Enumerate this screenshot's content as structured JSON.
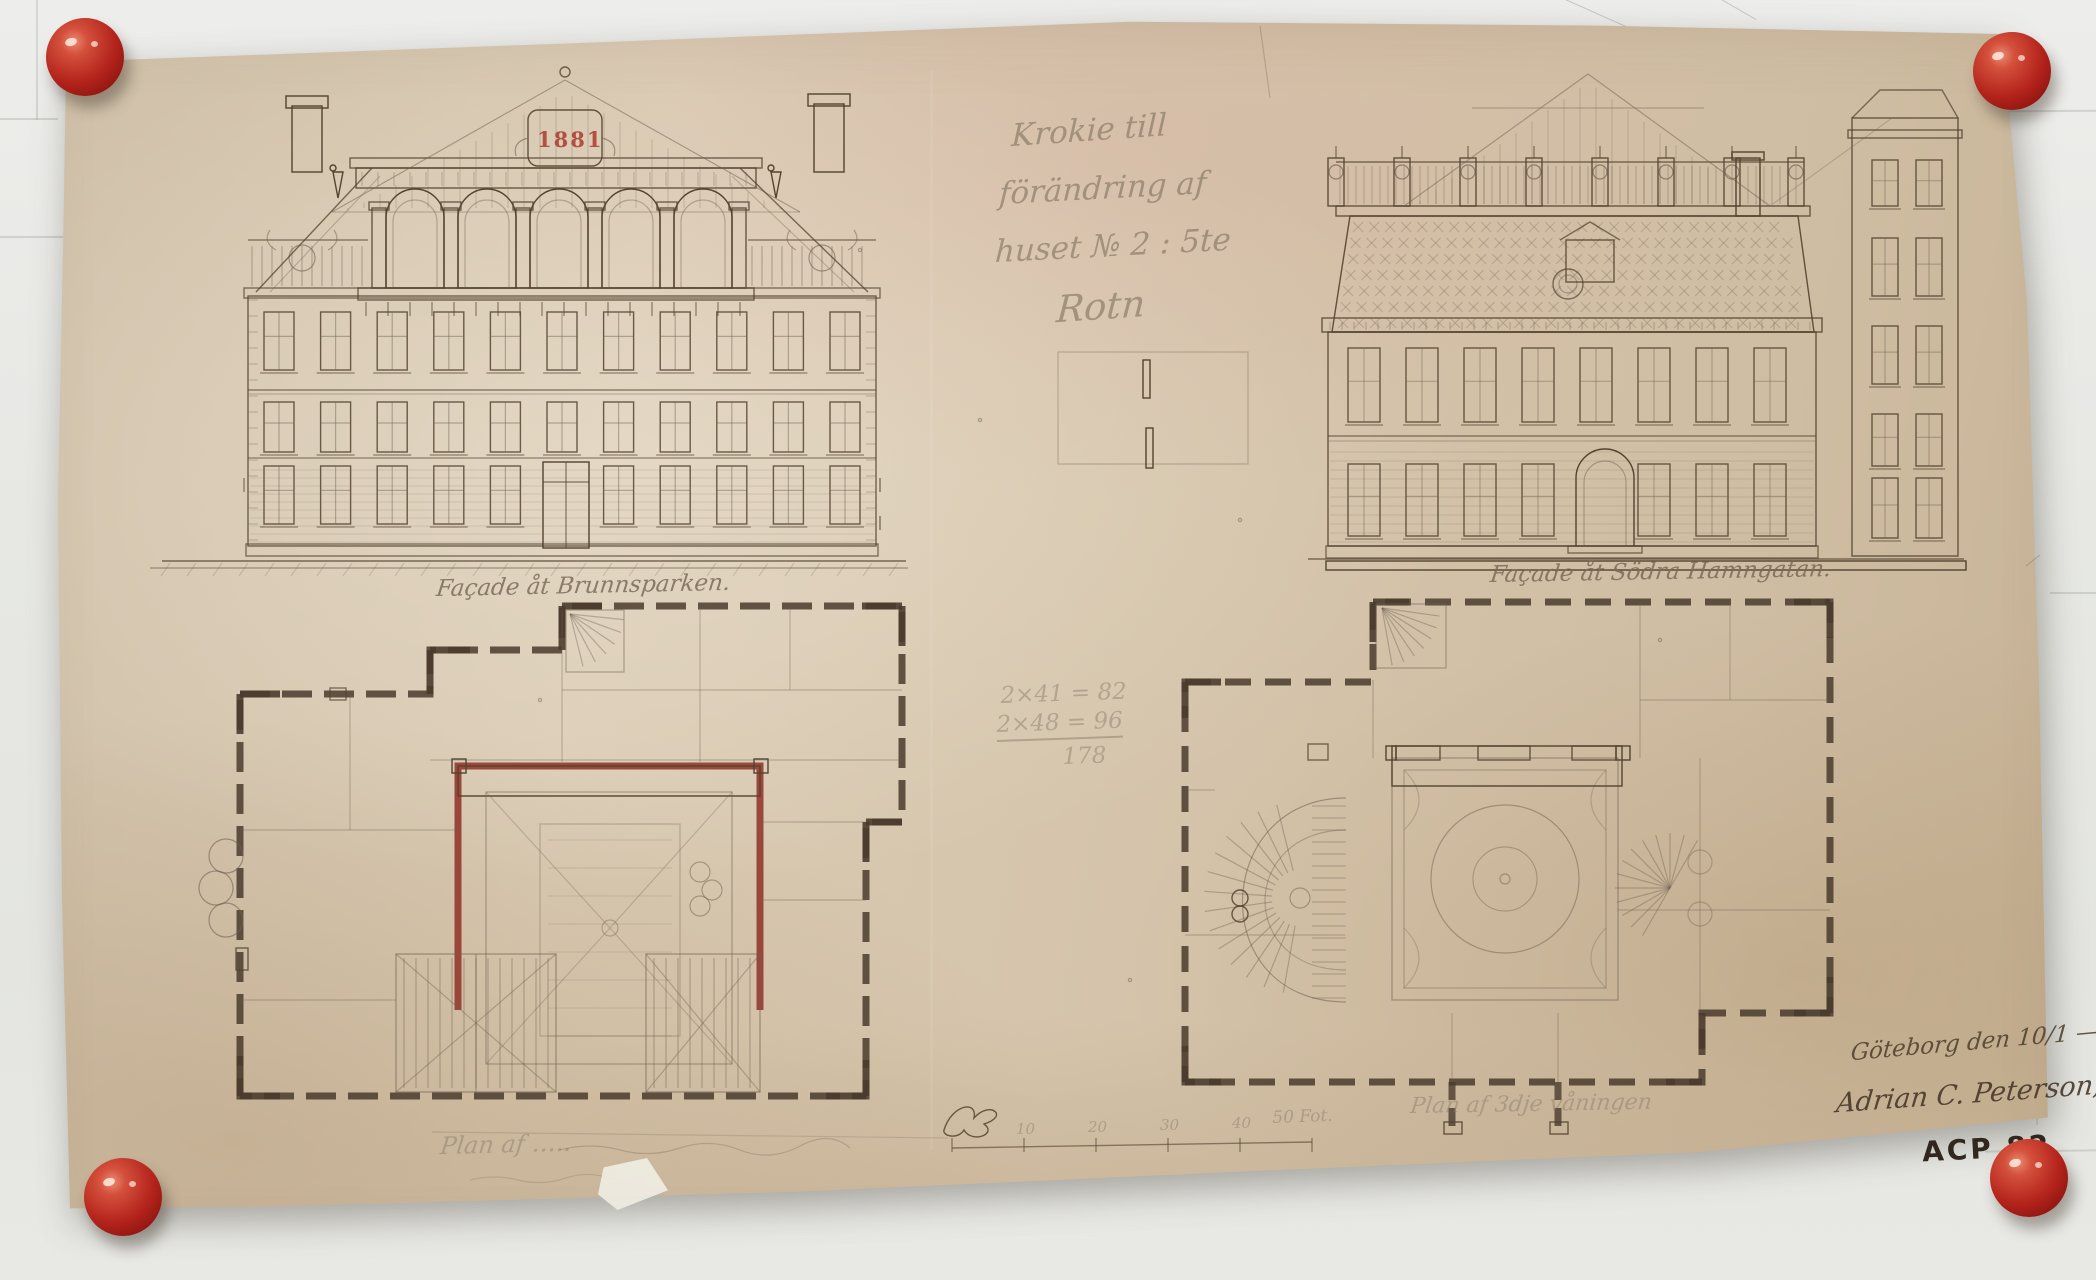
{
  "artifact": {
    "title_block": {
      "line1": "Krokie till",
      "line2": "förändring af",
      "line3": "huset № 2 : 5te",
      "line4": "Rotn"
    },
    "facades": {
      "left_caption": "Façade åt Brunnsparken.",
      "right_caption": "Façade åt Södra Hamngatan.",
      "date_cartouche": "1881"
    },
    "plans": {
      "left_caption": "Plan af …..",
      "right_caption": "Plan af 3dje våningen"
    },
    "calculation": {
      "line1": "2×41 = 82",
      "line2": "2×48 = 96",
      "total": "178"
    },
    "scale_bar": {
      "tick_labels": [
        "10",
        "20",
        "30",
        "40"
      ],
      "end_label": "50 Fot."
    },
    "signature": {
      "place_date": "Göteborg den 10/1 — 82.",
      "name": "Adrian C. Peterson,",
      "stamp": "ACP 82"
    }
  },
  "colors": {
    "board": "#e9e9e5",
    "paper": "#d2c2ab",
    "paper-dark": "#c2ae93",
    "pencil": "#6f6152",
    "sepia": "#53432f",
    "wall-umber": "#4a3b2d",
    "wall-red": "#93392e",
    "ink-red": "#a83226",
    "pin-red": "#b6201a"
  }
}
